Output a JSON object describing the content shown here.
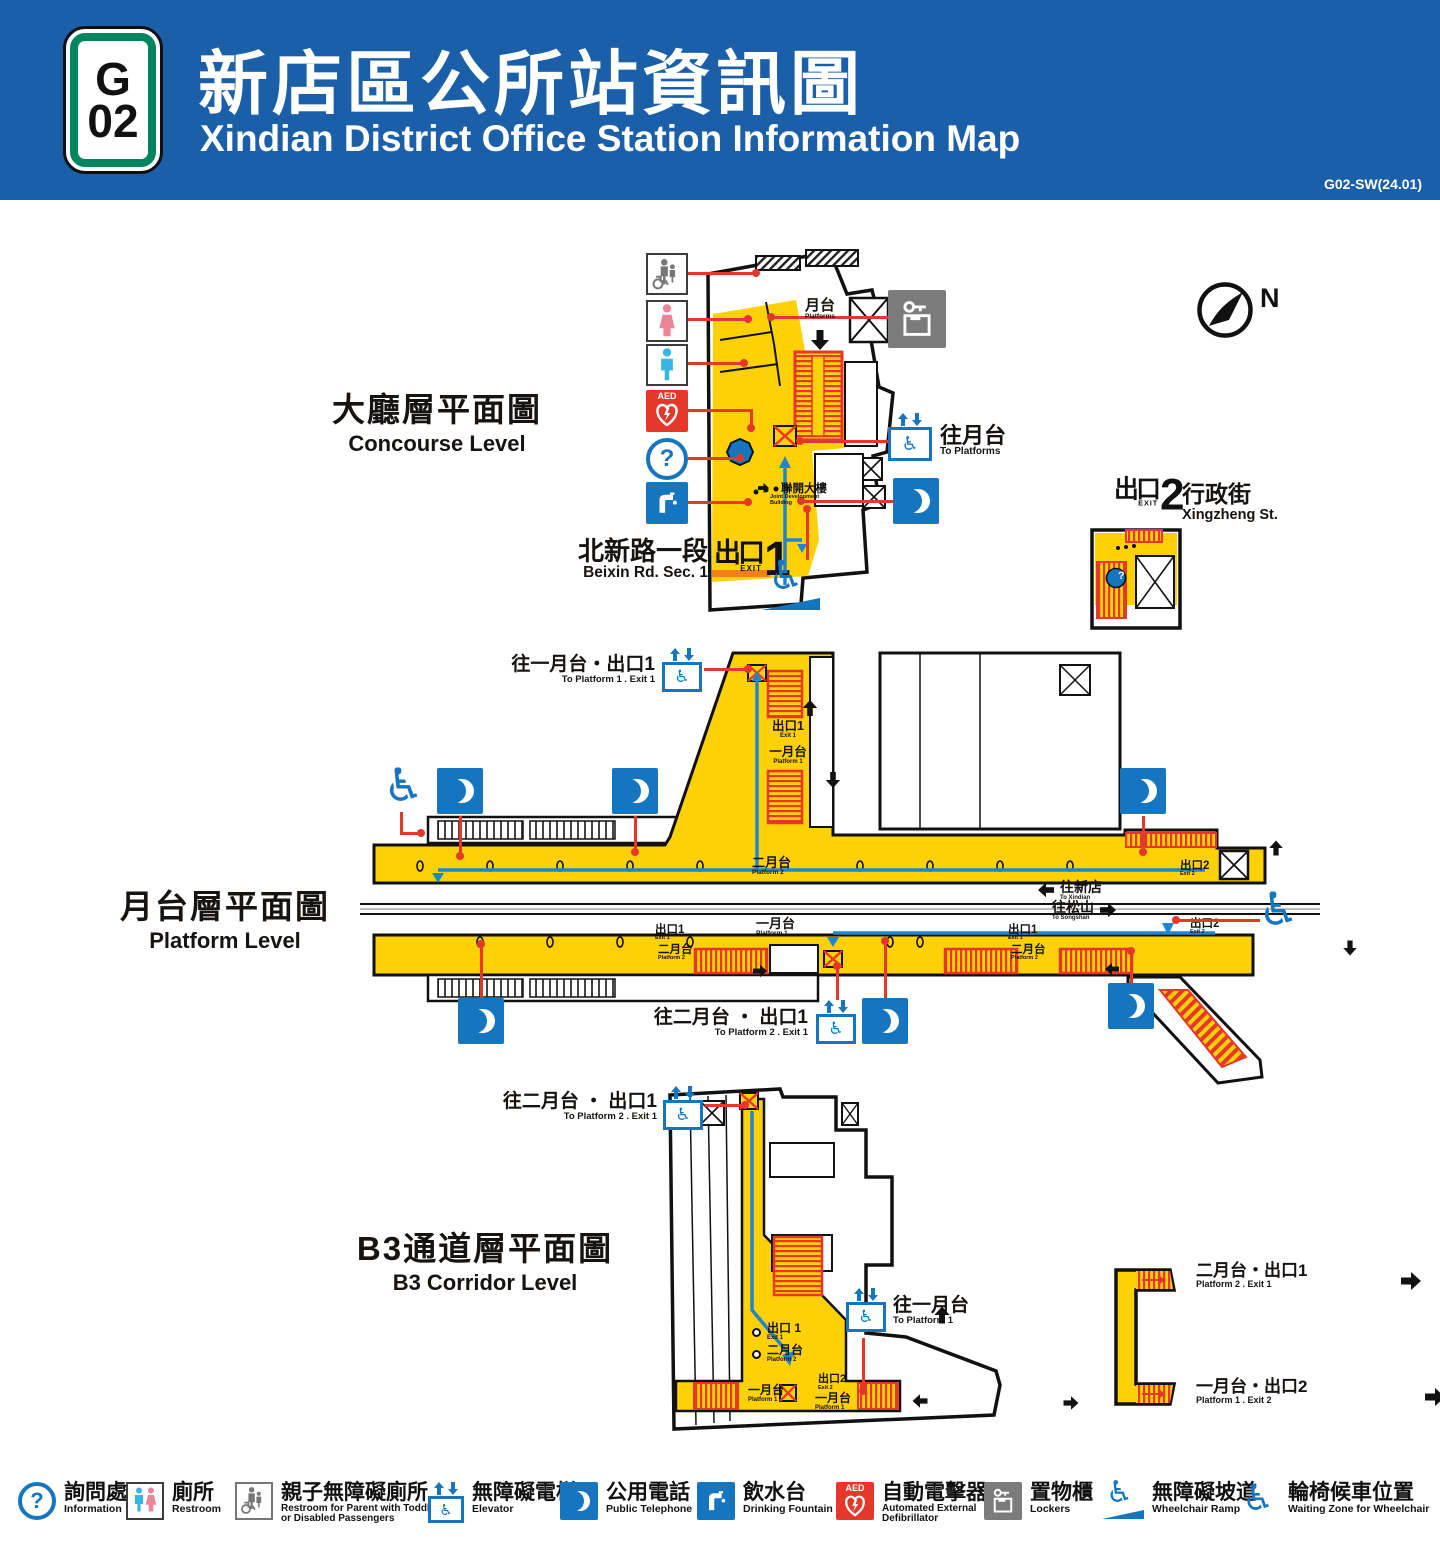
{
  "colors": {
    "header_blue": "#1a5fa8",
    "line_green": "#00855f",
    "map_yellow": "#fdd105",
    "stair_red": "#e6372b",
    "icon_blue": "#1576bf",
    "path_blue": "#1e86d0"
  },
  "header": {
    "badge_letter": "G",
    "badge_number": "02",
    "title_zh": "新店區公所站資訊圖",
    "title_en": "Xindian District Office Station Information Map",
    "version": "G02-SW(24.01)"
  },
  "icons": {
    "question": "?",
    "aed": "AED",
    "compass_n": "N"
  },
  "concourse": {
    "title_zh": "大廳層平面圖",
    "title_en": "Concourse Level",
    "platforms_zh": "月台",
    "platforms_en": "Platforms",
    "to_platforms_zh": "往月台",
    "to_platforms_en": "To Platforms",
    "joint_zh": "聯開大樓",
    "joint_en1": "Joint Development",
    "joint_en2": "Building",
    "road_zh": "北新路一段",
    "road_en": "Beixin Rd. Sec. 1",
    "exit_word": "出口",
    "exit_caption": "EXIT",
    "exit1_number": "1",
    "exit2_number": "2",
    "street2_zh": "行政街",
    "street2_en": "Xingzheng St."
  },
  "platform": {
    "title_zh": "月台層平面圖",
    "title_en": "Platform Level",
    "to_p1_exit1_zh": "往一月台・出口1",
    "to_p1_exit1_en": "To Platform 1 . Exit 1",
    "to_p2_exit1_zh": "往二月台 ・ 出口1",
    "to_p2_exit1_en": "To Platform 2 . Exit 1",
    "exit1_zh": "出口1",
    "exit1_en": "Exit 1",
    "exit2_zh": "出口2",
    "exit2_en": "Exit 2",
    "p1_zh": "一月台",
    "p1_en": "Platform 1",
    "p2_zh": "二月台",
    "p2_en": "Platform 2",
    "to_xindian_zh": "往新店",
    "to_xindian_en": "To Xindian",
    "to_songshan_zh": "往松山",
    "to_songshan_en": "To Songshan"
  },
  "b3": {
    "title_zh": "B3通道層平面圖",
    "title_en": "B3 Corridor Level",
    "to_p2_exit1_zh": "往二月台 ・ 出口1",
    "to_p2_exit1_en": "To Platform 2 . Exit 1",
    "to_p1_zh": "往一月台",
    "to_p1_en": "To Platform 1",
    "exit1_zh": "出口 1",
    "exit1_en": "Exit 1",
    "p2_zh": "二月台",
    "p2_en": "Platform 2",
    "p1_zh": "一月台",
    "p1_en": "Platform 1",
    "exit2_zh": "出口2",
    "exit2_en": "Exit 2",
    "corridor_top_zh": "二月台・出口1",
    "corridor_top_en": "Platform 2 . Exit 1",
    "corridor_bottom_zh": "一月台・出口2",
    "corridor_bottom_en": "Platform 1 . Exit 2"
  },
  "legend": {
    "items": [
      {
        "id": "information",
        "zh": "詢問處",
        "en": "Information"
      },
      {
        "id": "restroom",
        "zh": "廁所",
        "en": "Restroom"
      },
      {
        "id": "family-restroom",
        "zh": "親子無障礙廁所",
        "en": "Restroom for Parent with Toddler",
        "en2": "or Disabled Passengers"
      },
      {
        "id": "elevator",
        "zh": "無障礙電梯",
        "en": "Elevator"
      },
      {
        "id": "public-telephone",
        "zh": "公用電話",
        "en": "Public Telephone"
      },
      {
        "id": "drinking-fountain",
        "zh": "飲水台",
        "en": "Drinking Fountain"
      },
      {
        "id": "aed",
        "zh": "自動電擊器",
        "en": "Automated External",
        "en2": "Defibrillator"
      },
      {
        "id": "lockers",
        "zh": "置物櫃",
        "en": "Lockers"
      },
      {
        "id": "wheelchair-ramp",
        "zh": "無障礙坡道",
        "en": "Wheelchair Ramp"
      },
      {
        "id": "wheelchair-waiting",
        "zh": "輪椅候車位置",
        "en": "Waiting Zone for Wheelchair"
      }
    ]
  }
}
